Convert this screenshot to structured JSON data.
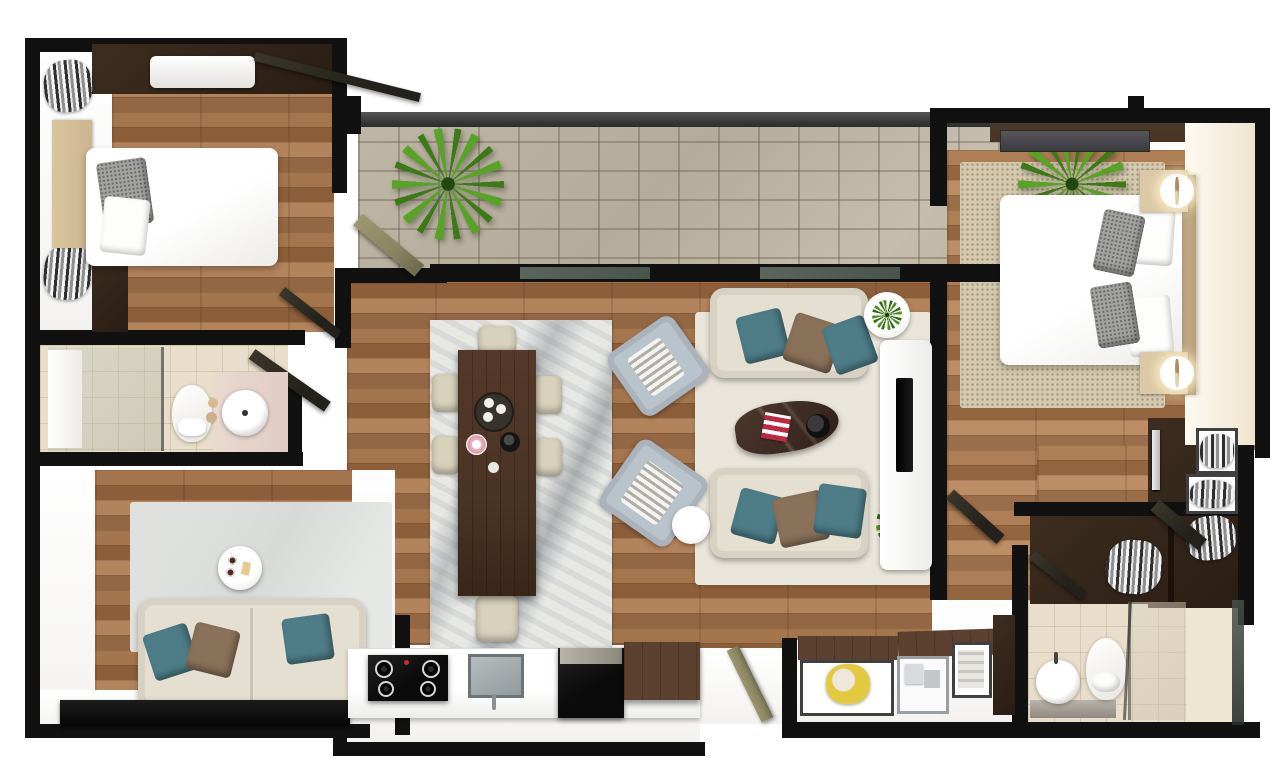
{
  "meta": {
    "title": "Two-bedroom apartment 3D floor plan, top-down render",
    "view": "top-down orthographic",
    "visible_text": "none"
  },
  "colors": {
    "wall": "#111111",
    "wood": "#a5764e",
    "woodDark": "#8c5f3a",
    "woodLight": "#b3835c",
    "stone": "#b4ab9a",
    "tile": "#e9decb",
    "rugGray": "#d8dad8",
    "rugCream": "#e9e5da",
    "rugSpeckle": "#d4c8af",
    "rugDining": "#e7e8e4",
    "sofa": "#e4dfd0",
    "chair": "#d8d1bc",
    "armchair": "#b9c3cc",
    "teal": "#4e7d88",
    "pbrown": "#8a7159",
    "walnut": "#4a3425",
    "marble": "#3c2b22",
    "plant": "#58a326",
    "plantDark": "#3c7a16",
    "doorOlive": "#8a8562",
    "doorDark": "#23211b",
    "counterWood": "#5c4130",
    "appliance": "#0b0b0b",
    "headboard": "#cdb68f",
    "nightstand": "#dbc8a6",
    "towel": "#e3c93f",
    "railing": "#3a3a3a"
  },
  "rooms": [
    {
      "id": "bedroom-1",
      "name": "Bedroom 1 with single bed, wardrobe and open closets"
    },
    {
      "id": "balcony",
      "name": "Stone-paved balcony with two palm plants"
    },
    {
      "id": "master-bedroom",
      "name": "Master bedroom with double bed, nightstands and lamps"
    },
    {
      "id": "bathroom-1",
      "name": "Bathroom with shower, toilet and round basin"
    },
    {
      "id": "den",
      "name": "Den with loveseat, grey rug and media console"
    },
    {
      "id": "dining-room",
      "name": "Dining room with walnut table and six chairs"
    },
    {
      "id": "living-room",
      "name": "Living room with two sofas, armchairs and marble coffee table"
    },
    {
      "id": "kitchen",
      "name": "Kitchen with cooktop, sink and appliances"
    },
    {
      "id": "entry",
      "name": "Entry with open door"
    },
    {
      "id": "laundry",
      "name": "Laundry with washer and baskets"
    },
    {
      "id": "bathroom-2",
      "name": "Second bathroom with shower, toilet and basin"
    },
    {
      "id": "walk-in-closet",
      "name": "Walk-in closet with hanging clothes"
    },
    {
      "id": "wardrobe",
      "name": "Wardrobe shelving with folded clothes"
    }
  ],
  "furniture": {
    "bedroom1": [
      "single bed with grey pillow",
      "light wood headboard",
      "dark wardrobe band",
      "two open closet shelves with clothes"
    ],
    "balcony": [
      "palm plant left",
      "palm plant right",
      "dark railing",
      "two angled open doors",
      "sliding glass door"
    ],
    "master": [
      "double bed with grey pillows",
      "speckled rug",
      "two nightstands",
      "two round lamps",
      "headboard panel",
      "sliding wardrobe"
    ],
    "living": [
      "cream area rug",
      "sofa top",
      "sofa bottom",
      "teal pillows",
      "brown pillows",
      "two grey armchairs with throws",
      "marble coffee table",
      "magazine",
      "round side table with plant",
      "small round table",
      "floor plant",
      "tv media unit"
    ],
    "dining": [
      "abstract grey rug",
      "walnut dining table",
      "six cream chairs",
      "round serving tray",
      "vase",
      "pink plate"
    ],
    "den": [
      "grey rug",
      "cream loveseat",
      "teal and brown pillows",
      "round white side table",
      "black media console"
    ],
    "kitchen": [
      "white counter",
      "black cooktop with four burners",
      "inset sink",
      "black tall appliance",
      "dark wood counter"
    ],
    "laundry": [
      "wood counter",
      "open cabinet with yellow towels",
      "washing machine",
      "toys"
    ],
    "bathroom2": [
      "round basin",
      "toilet",
      "glass shower",
      "angled door"
    ],
    "closet": [
      "hanging clothes rows",
      "dark shelving"
    ]
  }
}
